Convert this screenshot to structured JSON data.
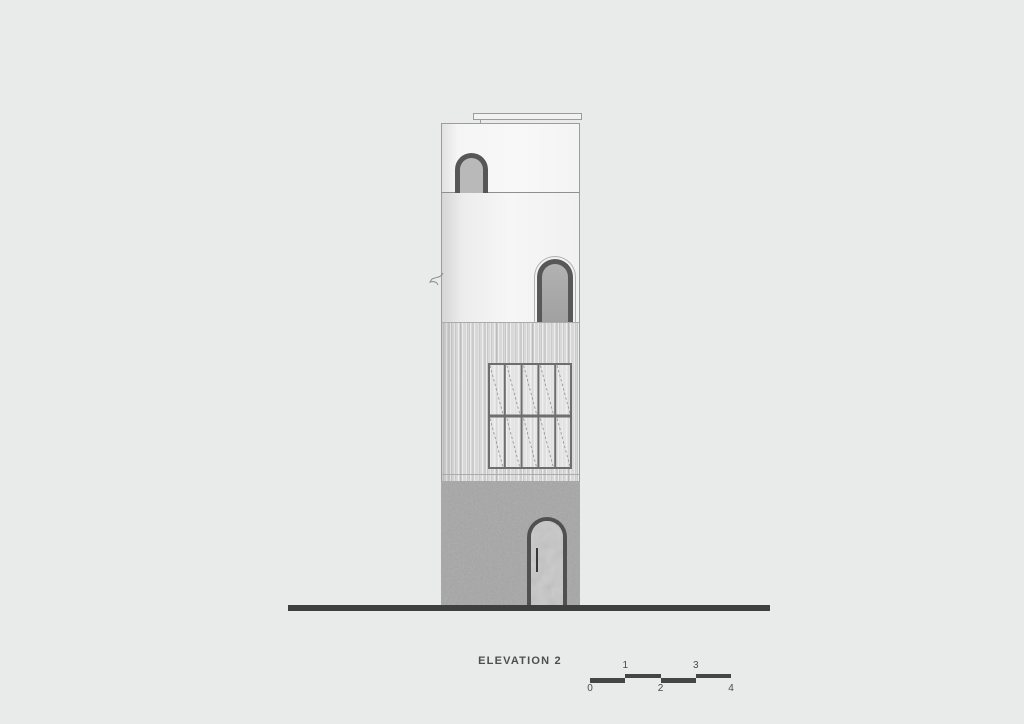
{
  "drawing": {
    "title": "ELEVATION 2",
    "scale_bar": {
      "labels": [
        "0",
        "1",
        "2",
        "3",
        "4"
      ],
      "segment_pattern": [
        "low",
        "high",
        "low",
        "high"
      ],
      "color": "#454545"
    },
    "building": {
      "sections": [
        {
          "name": "roof-parapet",
          "finish": "white-plaster"
        },
        {
          "name": "upper-wall",
          "finish": "white-plaster"
        },
        {
          "name": "clad-wall",
          "finish": "vertical-slats"
        },
        {
          "name": "base",
          "finish": "concrete"
        }
      ],
      "windows": [
        {
          "name": "arched-window-upper"
        },
        {
          "name": "arched-window-middle"
        }
      ],
      "door": {
        "name": "arched-entry-door",
        "has_handle": true
      },
      "louver_window": {
        "columns": 5,
        "rows": 2,
        "mullion_color": "#6e6e6e",
        "panel_color": "rgba(240,240,240,0.55)",
        "diagonal_color": "#8f8f8f"
      }
    },
    "colors": {
      "background": "#e9eaea",
      "outline": "#9c9c9c",
      "window_frame": "#565656",
      "ground_line": "#3f3f3f",
      "text": "#4e4e4e",
      "concrete": "#a6a6a6",
      "cladding": "#d8d8d8",
      "glass_upper": "#b9b9b9",
      "glass_middle": "#a8a8a8",
      "door_infill": "#c7c7c7"
    }
  }
}
